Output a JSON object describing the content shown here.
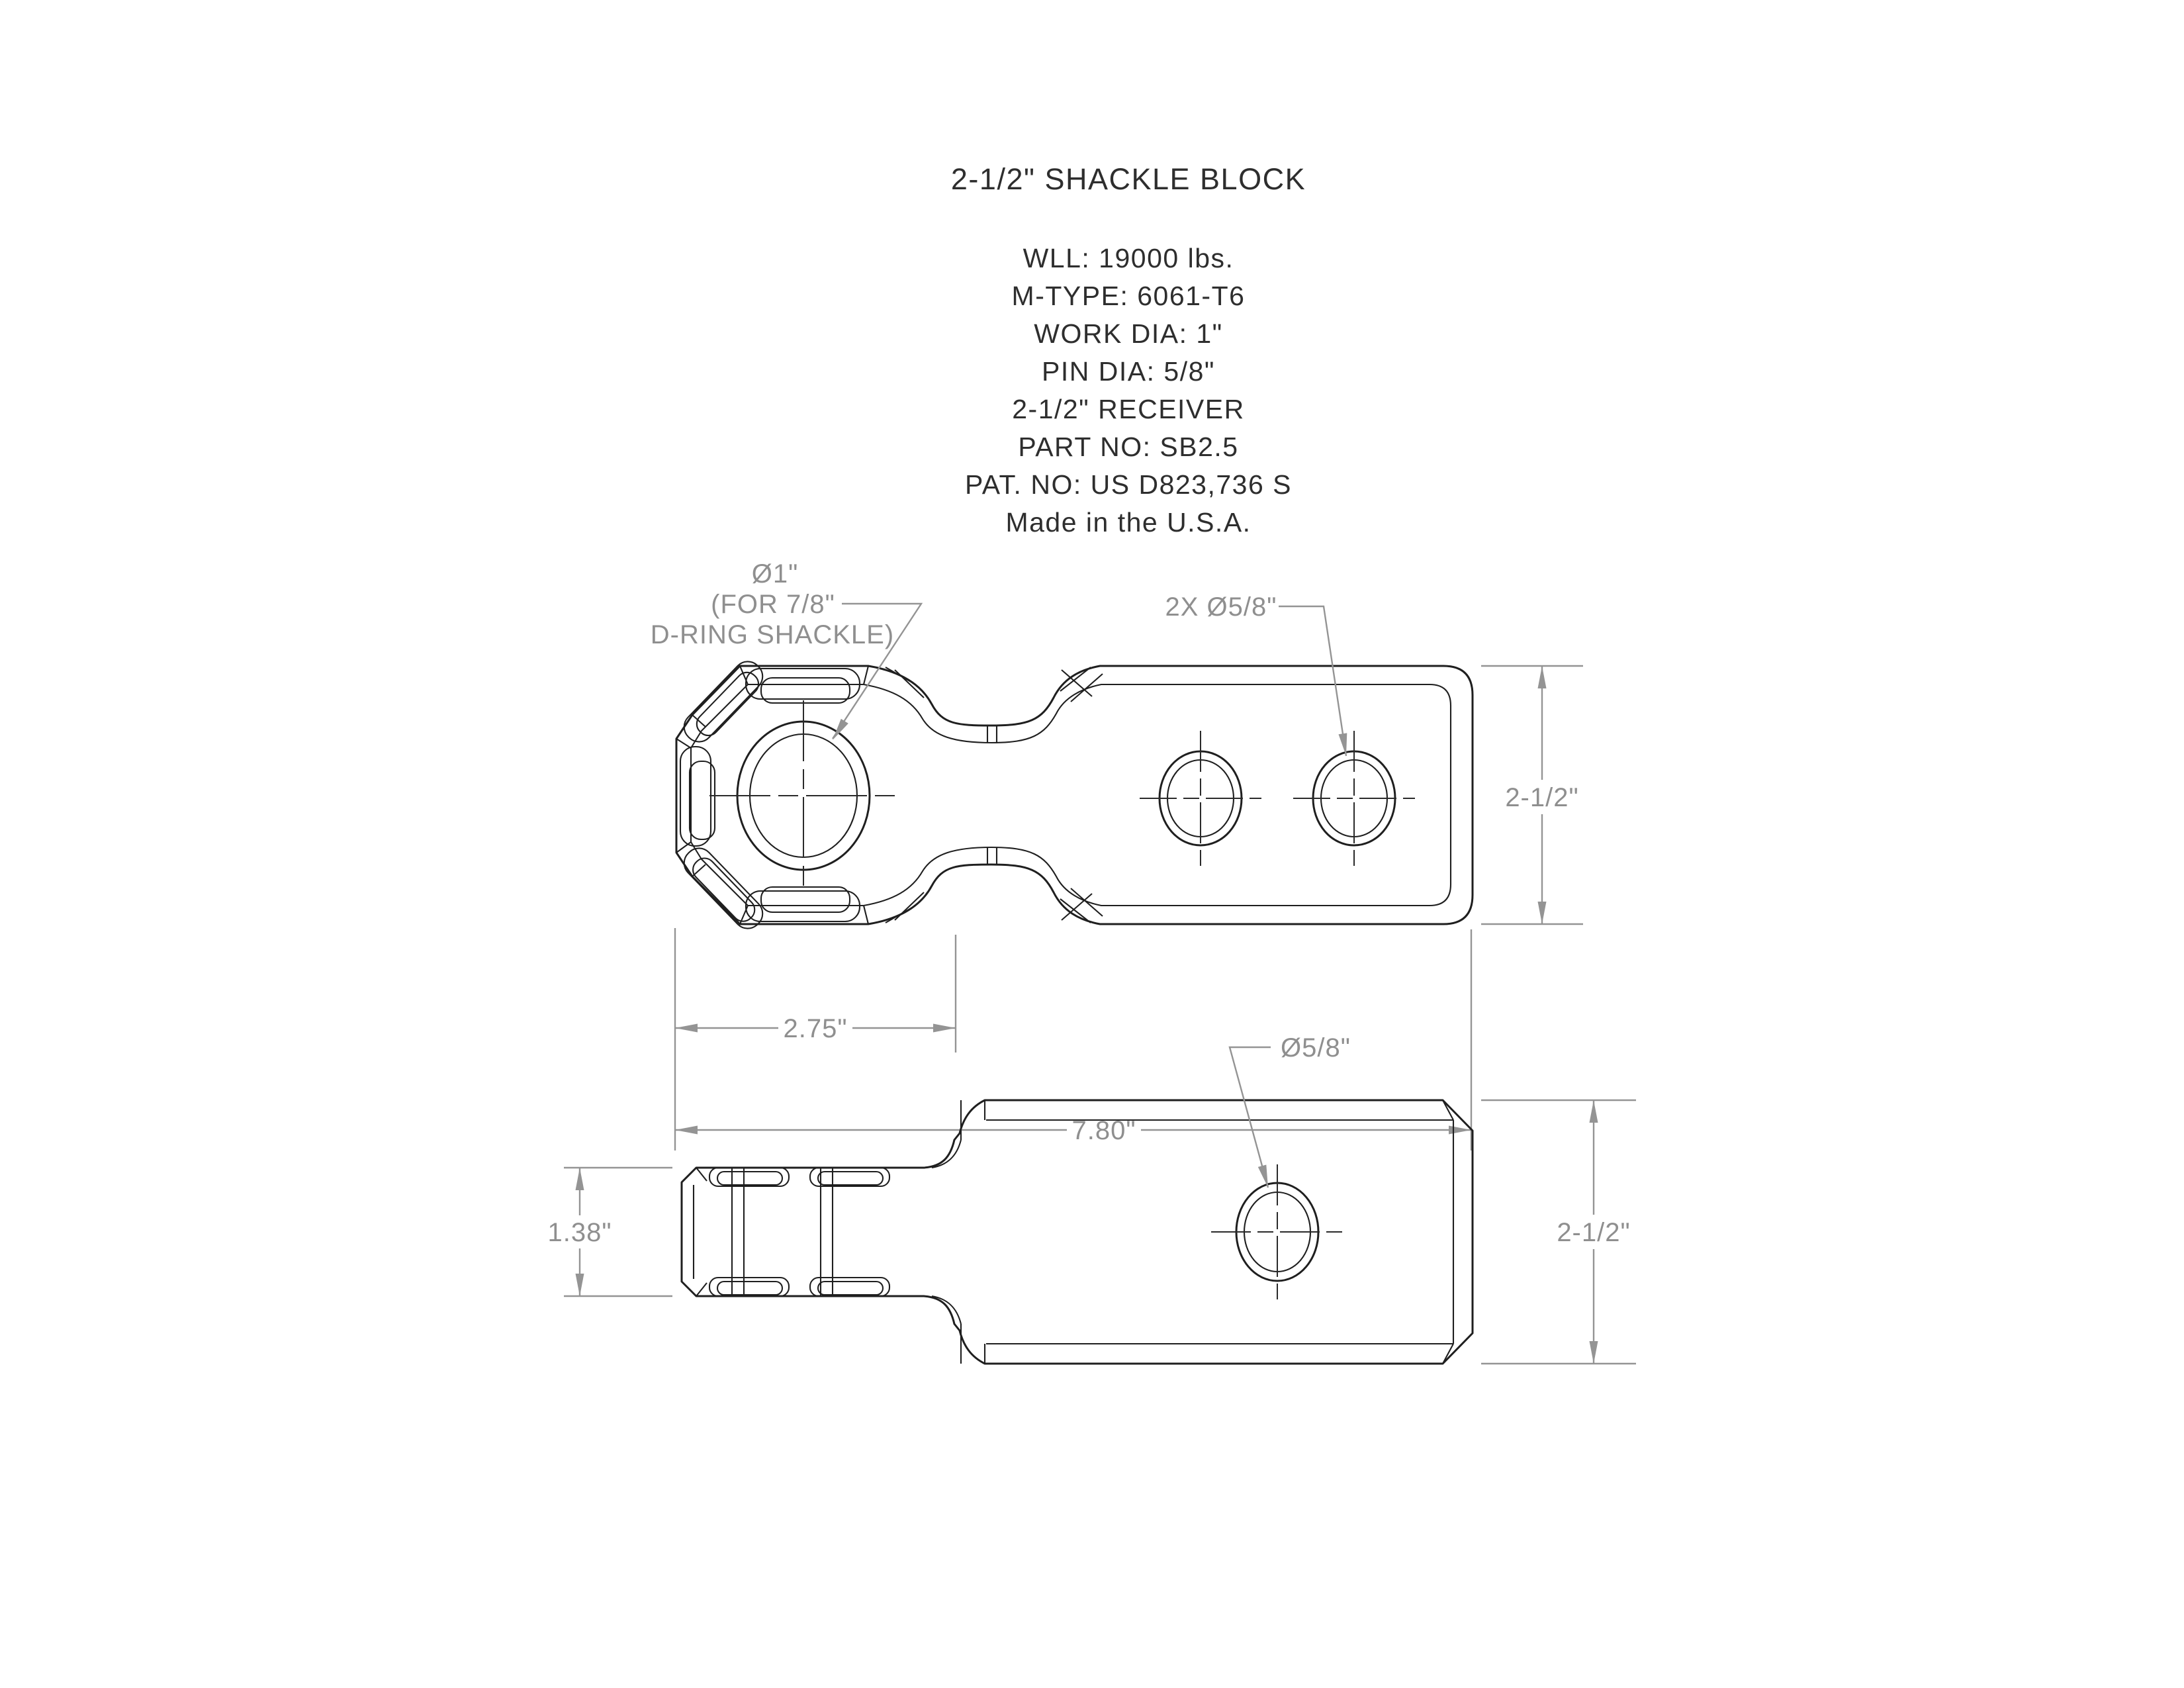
{
  "drawing": {
    "title": "2-1/2\" SHACKLE BLOCK",
    "specs": [
      "WLL: 19000 lbs.",
      "M-TYPE: 6061-T6",
      "WORK DIA: 1\"",
      "PIN DIA: 5/8\"",
      "2-1/2\" RECEIVER",
      "PART NO: SB2.5",
      "PAT. NO: US D823,736 S",
      "Made in the U.S.A."
    ],
    "colors": {
      "line": "#1f1f1f",
      "dimension": "#949494",
      "background": "#ffffff"
    },
    "top_view": {
      "labels": {
        "main_hole": [
          "Ø1\"",
          "(FOR 7/8\"",
          "D-RING SHACKLE)"
        ],
        "pin_holes": "2X Ø5/8\""
      },
      "dimensions": {
        "width_label": "2-1/2\"",
        "head_length_label": "2.75\"",
        "total_length_label": "7.80\""
      }
    },
    "side_view": {
      "labels": {
        "pin_hole": "Ø5/8\""
      },
      "dimensions": {
        "head_height_label": "1.38\"",
        "width_label": "2-1/2\""
      }
    }
  }
}
